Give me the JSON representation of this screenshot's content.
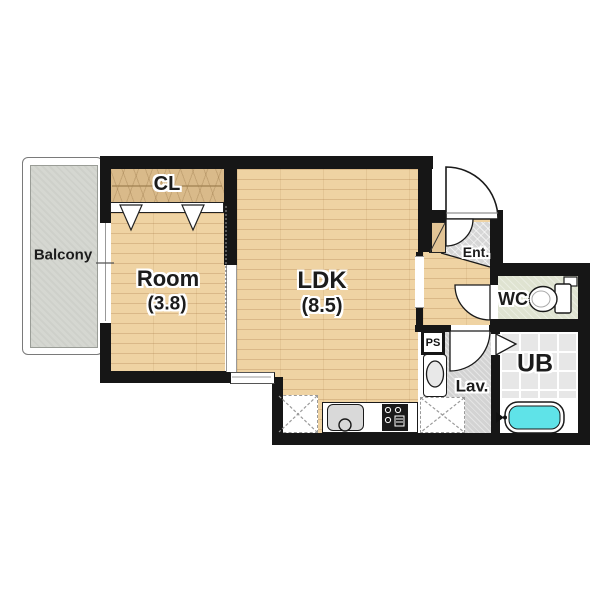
{
  "plan_title": "1K apartment floor plan",
  "rooms": {
    "balcony": {
      "label": "Balcony"
    },
    "closet": {
      "label": "CL"
    },
    "room": {
      "label": "Room",
      "size": "(3.8)"
    },
    "ldk": {
      "label": "LDK",
      "size": "(8.5)"
    },
    "entrance": {
      "label": "Ent."
    },
    "wc": {
      "label": "WC"
    },
    "unit_bath": {
      "label": "UB"
    },
    "lavatory": {
      "label": "Lav."
    },
    "pipe_space": {
      "label": "PS"
    }
  },
  "fixtures": [
    "kitchen-counter",
    "kitchen-sink",
    "gas-stove",
    "refrigerator-space",
    "washing-machine-space",
    "lavatory-sink",
    "toilet",
    "bathtub",
    "shoe-cabinet",
    "closet-folding-doors",
    "entrance-door",
    "wc-door",
    "lavatory-door",
    "bath-folding-door",
    "balcony-window",
    "kitchen-window"
  ],
  "colors": {
    "wall": "#161616",
    "wood_floor": "#efd3a3",
    "closet_wood": "#d9ba8a",
    "balcony_floor": "#d5d7d1",
    "entrance_tile": "#d6d6d6",
    "wc_floor": "#dfe3d1",
    "lavatory_floor": "#d3d3d3",
    "bath_tile": "#e7e7e7",
    "bathtub_water": "#5fe3e8"
  }
}
